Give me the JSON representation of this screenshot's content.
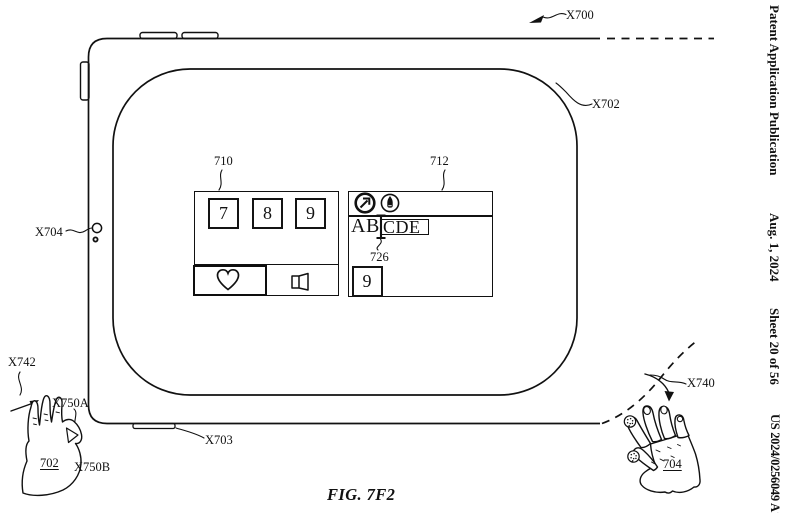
{
  "page_header": {
    "publication": "Patent Application Publication",
    "date": "Aug. 1, 2024",
    "sheet": "Sheet 20 of 56",
    "publication_number": "US 2024/0256049 A1"
  },
  "figure": {
    "caption": "FIG. 7F2"
  },
  "callouts": {
    "device": "X700",
    "display": "X702",
    "bottom_edge": "X703",
    "camera": "X704",
    "right_hand_gesture": "X740",
    "left_hand_gesture": "X742",
    "pinch_upper": "X750A",
    "pinch_lower": "X750B",
    "left_hand": "702",
    "right_hand": "704",
    "keypad_window": "710",
    "text_window": "712",
    "text_cursor": "726"
  },
  "keypad_window": {
    "keys": [
      "7",
      "8",
      "9"
    ],
    "tabs": [
      {
        "icon": "heart-icon",
        "selected": true
      },
      {
        "icon": "page-icon",
        "selected": false
      }
    ]
  },
  "text_window": {
    "toolbar_icons": [
      {
        "icon": "launch-arrow-icon"
      },
      {
        "icon": "pen-icon"
      }
    ],
    "text_before_cursor": "AB",
    "field_text": "CDE",
    "key": "9"
  },
  "colors": {
    "ink": "#111111",
    "paper": "#ffffff"
  }
}
